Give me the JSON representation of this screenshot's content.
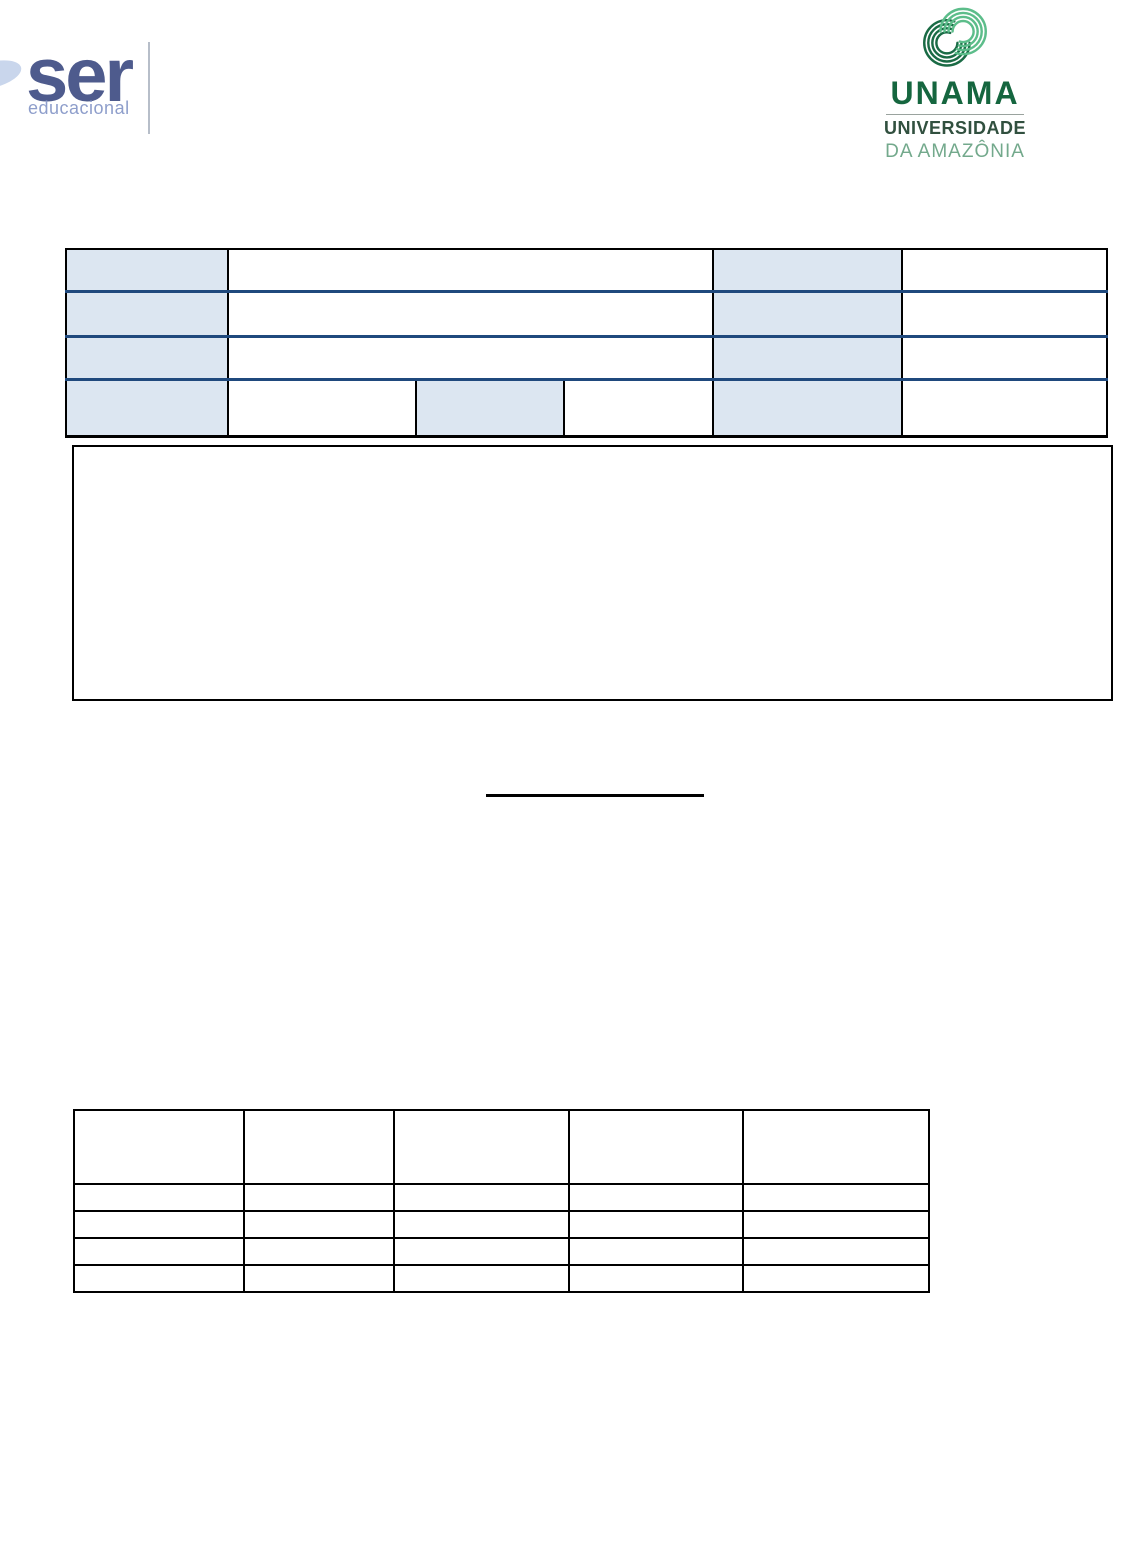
{
  "branding": {
    "ser": {
      "name": "ser",
      "tagline": "educacional",
      "name_color": "#4e5b8d",
      "tagline_color": "#8e9ecb",
      "swoosh_color": "#c9d6ec"
    },
    "unama": {
      "acronym": "UNAMA",
      "line1": "UNIVERSIDADE",
      "line2": "DA AMAZÔNIA",
      "acronym_color": "#15663f",
      "line1_color": "#31503f",
      "line2_color": "#73a98c",
      "icon_dark_green": "#1a6b45",
      "icon_light_green": "#5cbd8a"
    }
  },
  "info_table": {
    "shading_color": "#dce6f1",
    "row_separator_color": "#1f497d",
    "border_color": "#000000",
    "rows": [
      {
        "cells": [
          "",
          "",
          "",
          ""
        ]
      },
      {
        "cells": [
          "",
          "",
          "",
          ""
        ]
      },
      {
        "cells": [
          "",
          "",
          "",
          ""
        ]
      },
      {
        "cells": [
          "",
          "",
          "",
          "",
          "",
          ""
        ]
      }
    ]
  },
  "content_box": {
    "text": ""
  },
  "center_blank_line": {
    "text": ""
  },
  "grid_table": {
    "columns": 5,
    "header_row": [
      "",
      "",
      "",
      "",
      ""
    ],
    "rows": [
      [
        "",
        "",
        "",
        "",
        ""
      ],
      [
        "",
        "",
        "",
        "",
        ""
      ],
      [
        "",
        "",
        "",
        "",
        ""
      ],
      [
        "",
        "",
        "",
        "",
        ""
      ]
    ]
  }
}
